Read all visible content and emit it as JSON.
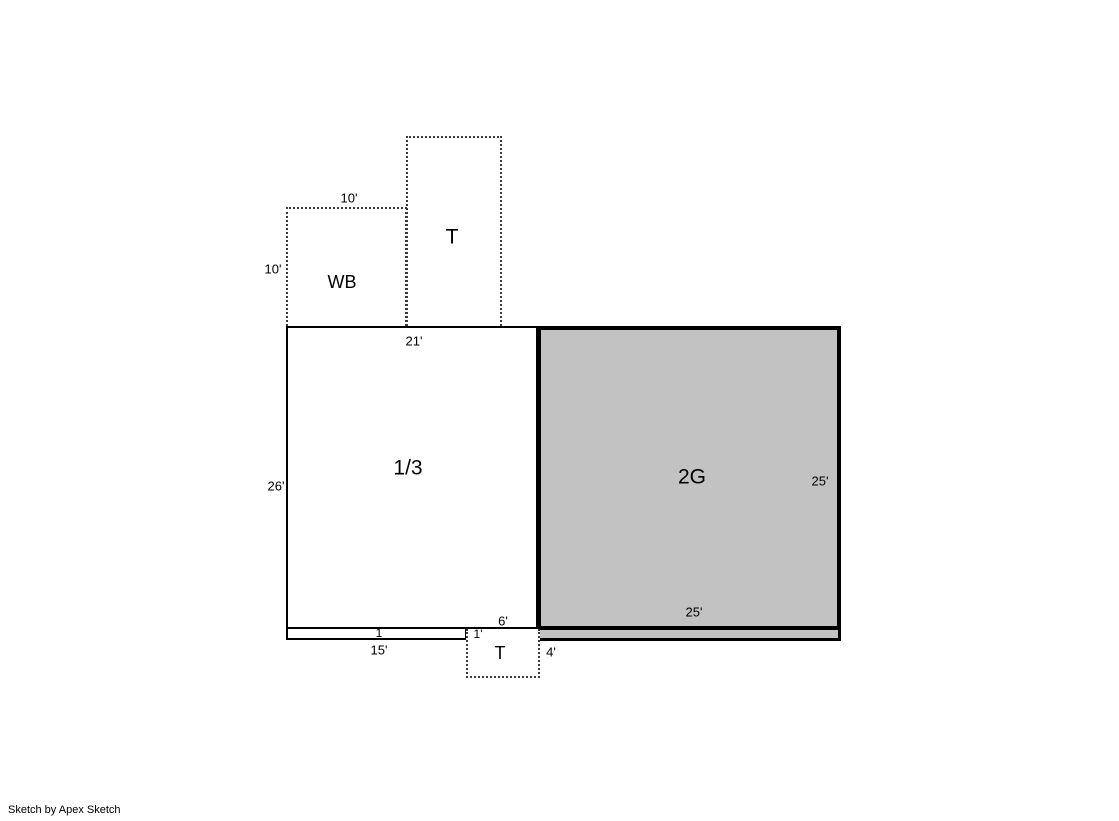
{
  "sketch": {
    "areas": {
      "t_top": {
        "label": "T"
      },
      "wb": {
        "label": "WB"
      },
      "main": {
        "label": "1/3"
      },
      "garage": {
        "label": "2G"
      },
      "strip": {
        "label": "1"
      },
      "t_bottom": {
        "label": "T"
      }
    },
    "dims": {
      "wb_width": "10'",
      "wb_height": "10'",
      "main_width": "21'",
      "main_height": "26'",
      "garage_right": "25'",
      "garage_bottom": "25'",
      "strip_width": "15'",
      "strip_height": "1'",
      "t_bottom_width": "6'",
      "t_bottom_height": "4'"
    },
    "colors": {
      "line": "#000000",
      "garage_fill": "#c2c2c2",
      "dotted_line": "#3a3a3a",
      "background": "#ffffff"
    }
  },
  "footer": {
    "credit": "Sketch by Apex Sketch"
  }
}
